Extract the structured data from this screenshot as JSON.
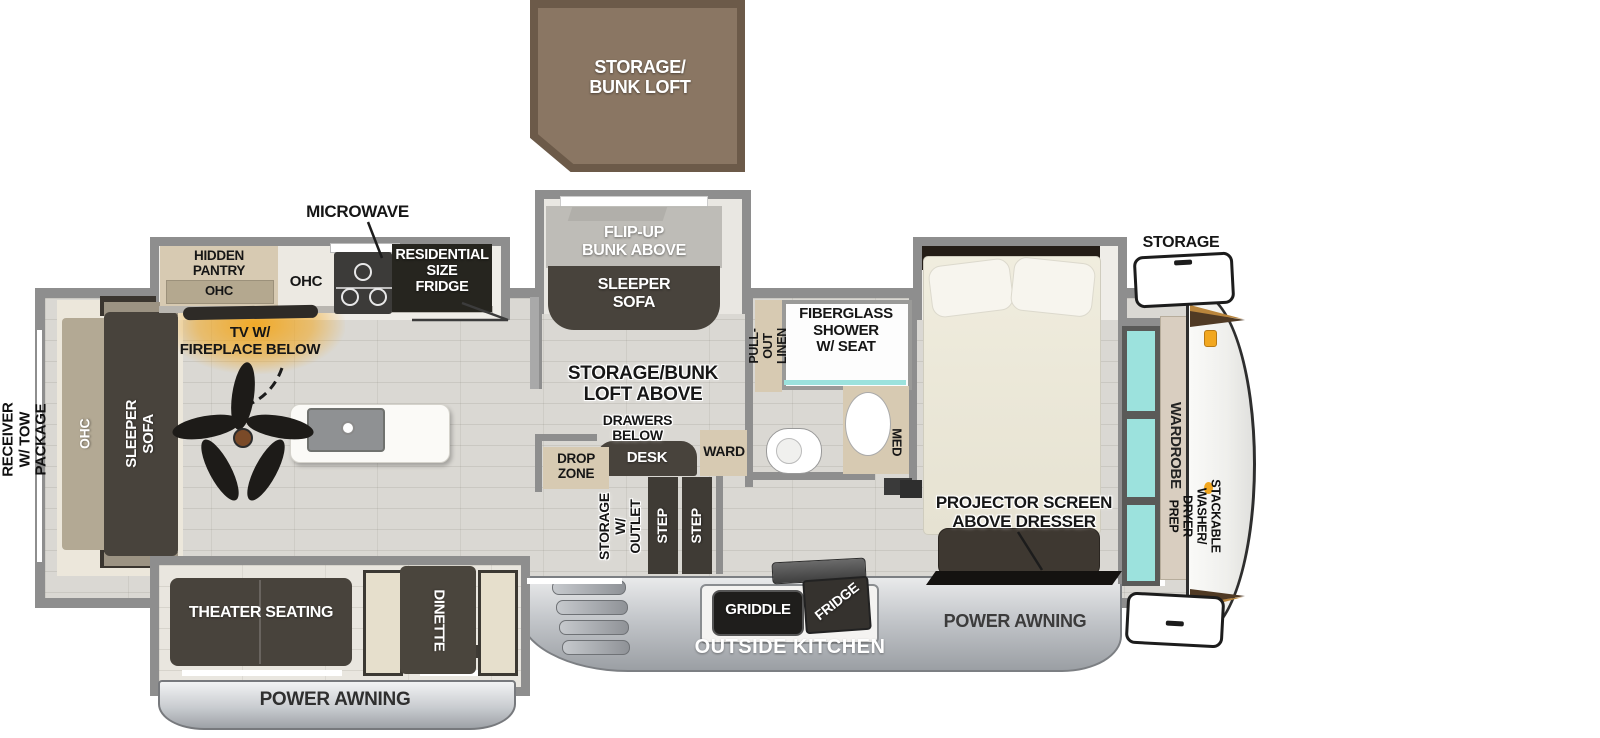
{
  "title": "RV fifth-wheel floorplan",
  "labels": {
    "loft": "STORAGE/\nBUNK LOFT",
    "microwave": "MICROWAVE",
    "hidden_pantry": "HIDDEN\nPANTRY",
    "pantry_ohc": "OHC",
    "kitchen_ohc": "OHC",
    "residential_fridge": "RESIDENTIAL\nSIZE\nFRIDGE",
    "flip_up_bunk": "FLIP-UP\nBUNK ABOVE",
    "slide_sleeper_sofa": "SLEEPER\nSOFA",
    "tv_fireplace": "TV W/\nFIREPLACE BELOW",
    "storage_bunk_loft_above": "STORAGE/BUNK\nLOFT ABOVE",
    "drawers_below": "DRAWERS\nBELOW",
    "desk": "DESK",
    "ward": "WARD",
    "drop_zone": "DROP\nZONE",
    "storage_outlet": "STORAGE\nW/ OUTLET",
    "step": "STEP",
    "pull_out_linen": "PULL-OUT\nLINEN",
    "shower": "FIBERGLASS\nSHOWER\nW/ SEAT",
    "med": "MED",
    "storage_front": "STORAGE",
    "rear_ohc": "OHC",
    "rear_sleeper_sofa": "SLEEPER SOFA",
    "receiver": "2\" RECEIVER\nW/ TOW PACKAGE",
    "wardrobe": "WARDROBE",
    "washer_prep": "STACKABLE WASHER/\nDRYER PREP",
    "projector": "PROJECTOR SCREEN\nABOVE DRESSER",
    "theater": "THEATER SEATING",
    "dinette": "DINETTE",
    "power_awning_left": "POWER AWNING",
    "power_awning_right": "POWER AWNING",
    "outside_kitchen": "OUTSIDE KITCHEN",
    "griddle": "GRIDDLE",
    "outside_fridge": "FRIDGE"
  },
  "colors": {
    "wall": "#8E8E8E",
    "floor": "#DAD8D3",
    "dark": "#48433C",
    "tan": "#D7CAB2",
    "teal": "#9CE2DD",
    "orange": "#F2A71F",
    "loft": "#8A7663",
    "loftborder": "#6C5A49",
    "appliance": "#26251F",
    "awning": "#B9BDC2"
  }
}
